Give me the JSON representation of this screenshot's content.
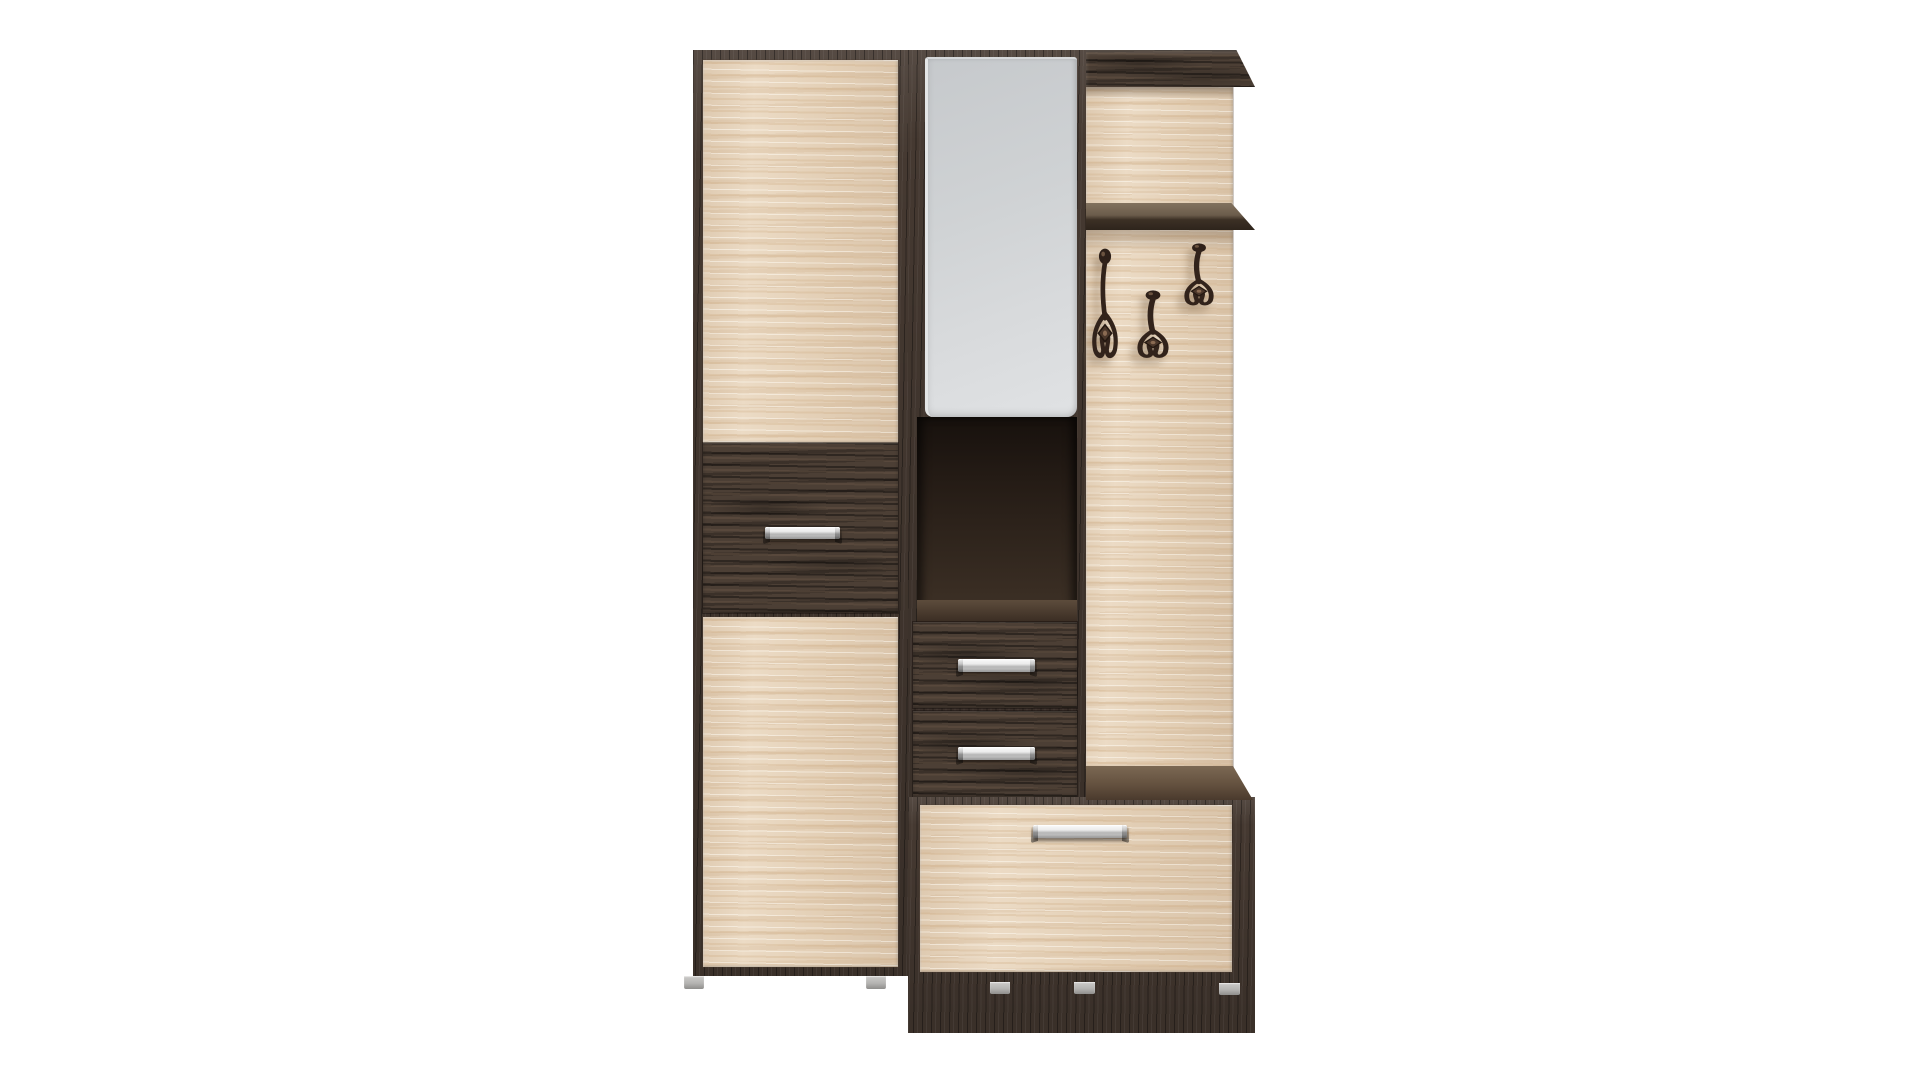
{
  "scene": {
    "kind": "product-photo",
    "subject": "two-tone hallway wardrobe set with mirror, coat hooks and shoe bench",
    "background": "#ffffff"
  },
  "colors": {
    "background": "#ffffff",
    "oak_light": "#e9d6bd",
    "oak_highlight": "#f4ead9",
    "oak_shade": "#d9c2a4",
    "wenge_dark": "#453931",
    "wenge_drawer": "#4c3f35",
    "wenge_deep": "#2c231d",
    "niche_interior": "#241b15",
    "shelf_top": "#82725f",
    "bench_top": "#7b6853",
    "mirror_glass": "#d3d5d7",
    "handle_silver": "#e2e2e2",
    "hook_metal": "#32231b",
    "foot_gray": "#c0bfbd"
  },
  "furniture": {
    "left_wardrobe": {
      "parts": [
        "top-door",
        "middle-drawer",
        "bottom-door"
      ],
      "handle_count": 1
    },
    "mirror_column": {
      "parts": [
        "mirror",
        "open-niche",
        "upper-drawer",
        "lower-drawer"
      ],
      "handle_count": 2
    },
    "coat_panel": {
      "parts": [
        "top-cornice",
        "hat-shelf",
        "coat-hooks"
      ],
      "hook_count": 3
    },
    "shoe_bench": {
      "parts": [
        "top-board",
        "flap-drawer"
      ],
      "handle_count": 1
    },
    "feet_count": 5
  }
}
